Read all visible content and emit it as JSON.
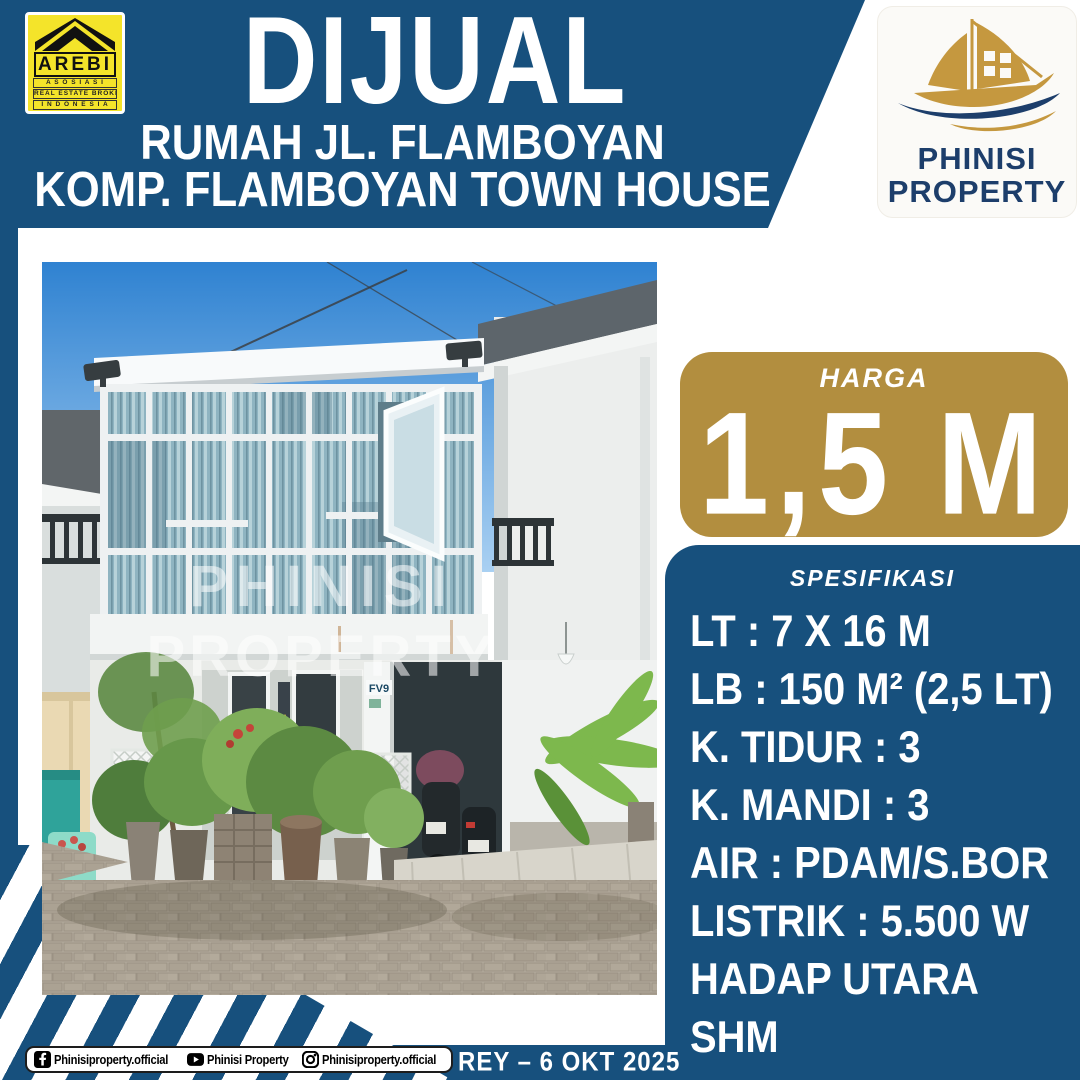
{
  "colors": {
    "primary_blue": "#17507D",
    "price_gold": "#B28E3F",
    "arebi_yellow": "#F4E42A",
    "logo_navy": "#1D3E6B",
    "ship_gold": "#C5983F"
  },
  "arebi_logo": {
    "title": "AREBI",
    "line1": "A S O S I A S I",
    "line2": "REAL ESTATE BROKER",
    "line3": "I N D O N E S I A",
    "line4": "DPD SULAWESI SELATAN"
  },
  "phinisi_logo": {
    "name_line1": "PHINISI",
    "name_line2": "PROPERTY"
  },
  "header": {
    "title": "DIJUAL",
    "subtitle_line1": "RUMAH JL. FLAMBOYAN",
    "subtitle_line2": "KOMP. FLAMBOYAN TOWN HOUSE"
  },
  "price": {
    "label": "HARGA",
    "value": "1,5 M"
  },
  "specs": {
    "heading": "SPESIFIKASI",
    "items": [
      "LT : 7 X 16 M",
      "LB : 150 M² (2,5 LT)",
      "K. TIDUR : 3",
      "K. MANDI : 3",
      "AIR : PDAM/S.BOR",
      "LISTRIK : 5.500 W",
      "HADAP UTARA",
      "SHM"
    ]
  },
  "photo": {
    "watermark_line1": "PHINISI",
    "watermark_line2": "PROPERTY",
    "house_number_sign": "FV9"
  },
  "footer": {
    "facebook_handle": "Phinisiproperty.official",
    "youtube_handle": "Phinisi Property",
    "instagram_handle": "Phinisiproperty.official",
    "agent_and_date": "REY – 6 OKT 2025"
  }
}
